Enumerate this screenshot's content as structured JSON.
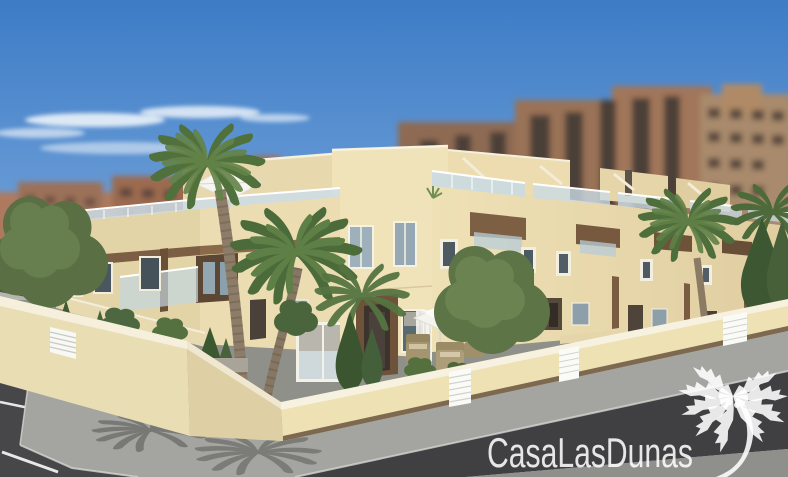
{
  "watermark": {
    "brand": "CasaLasDunas",
    "logo_icon": "palm-tree"
  },
  "colors": {
    "sky_top": "#3d7cc6",
    "sky_horizon": "#aecbe9",
    "cloud": "#ffffff",
    "background_buildings": "#9b7158",
    "facade_light": "#f1e3b9",
    "facade_shaded": "#e3d4a8",
    "wood_trim": "#7b5e43",
    "balustrade_glass": "#c9dbe5",
    "perimeter_wall": "#eee1b4",
    "wall_base_trim": "#7d6850",
    "street_asphalt": "#404043",
    "sidewalk": "#a4a4a0",
    "road_marking": "#e8e8e6",
    "palm_green": "#50703c",
    "tree_green": "#5a7044",
    "watermark_white": "rgba(255,255,255,0.87)"
  },
  "scene": {
    "type": "architectural-render",
    "subject": "Two-storey cream townhouse development with roof terraces and palm trees on a street corner",
    "elements": [
      "sky",
      "clouds",
      "background apartment blocks",
      "townhouse complex",
      "roof terraces with glass balustrades",
      "wood trim beams",
      "palm trees",
      "perimeter wall with white slatted gates",
      "corner street with parking lines",
      "sidewalk",
      "patio parasol and wicker furniture",
      "brand watermark"
    ]
  }
}
